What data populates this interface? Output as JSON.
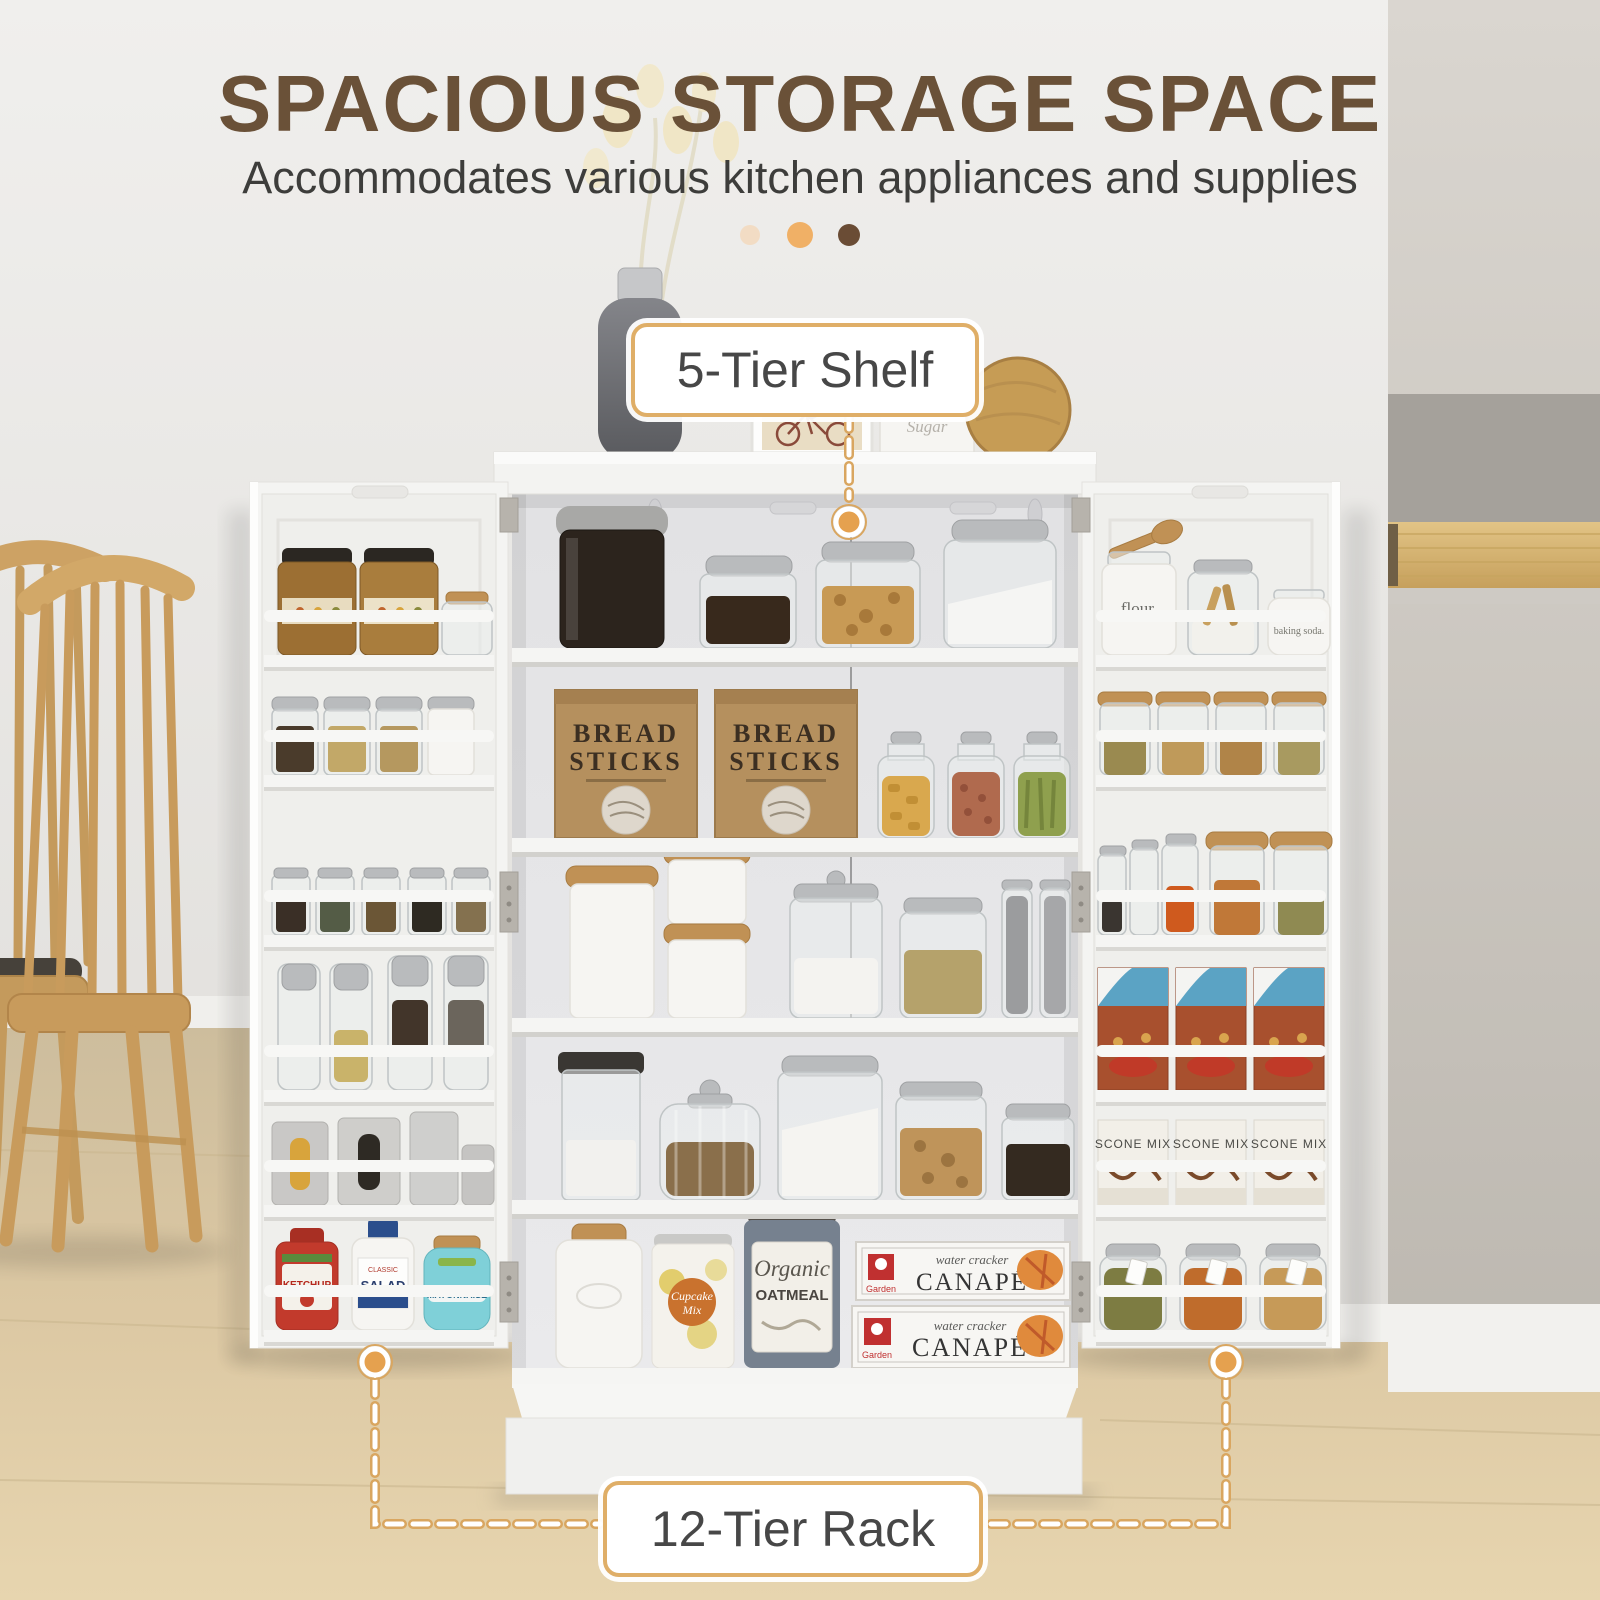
{
  "header": {
    "title": "SPACIOUS STORAGE SPACE",
    "subtitle": "Accommodates various kitchen appliances and supplies"
  },
  "carousel": {
    "dots": [
      {
        "color": "#f2dcc4"
      },
      {
        "color": "#f0b066"
      },
      {
        "color": "#6a4c35"
      }
    ]
  },
  "callouts": {
    "shelf_label": "5-Tier Shelf",
    "rack_label": "12-Tier Rack"
  },
  "colors": {
    "title_brown": "#6a5138",
    "accent_tan": "#dfae67",
    "connector_dot": "#e5a14f",
    "cabinet_white": "#f5f5f3",
    "floor_wood": "#dcc8a3"
  },
  "products": {
    "bread_bag": {
      "line1": "BREAD",
      "line2": "STICKS"
    },
    "scone_box": {
      "label": "SCONE MIX"
    },
    "canape_box": {
      "brand": "Garden",
      "type": "water cracker",
      "name": "CANAPÉ"
    },
    "oatmeal_can": {
      "line1": "Organic",
      "line2": "OATMEAL"
    },
    "cupcake_can": {
      "line1": "Cupcake",
      "line2": "Mix"
    },
    "ketchup_bottle": {
      "label": "KETCHUP"
    },
    "salad_bottle": {
      "top": "CLASSIC",
      "label": "SALAD"
    },
    "mayo_jar": {
      "label": "MAYONNAISE"
    },
    "flour_jar": {
      "label": "flour."
    },
    "baking_soda_jar": {
      "label": "baking soda."
    },
    "sugar_canister": {
      "label": "Sugar"
    }
  }
}
